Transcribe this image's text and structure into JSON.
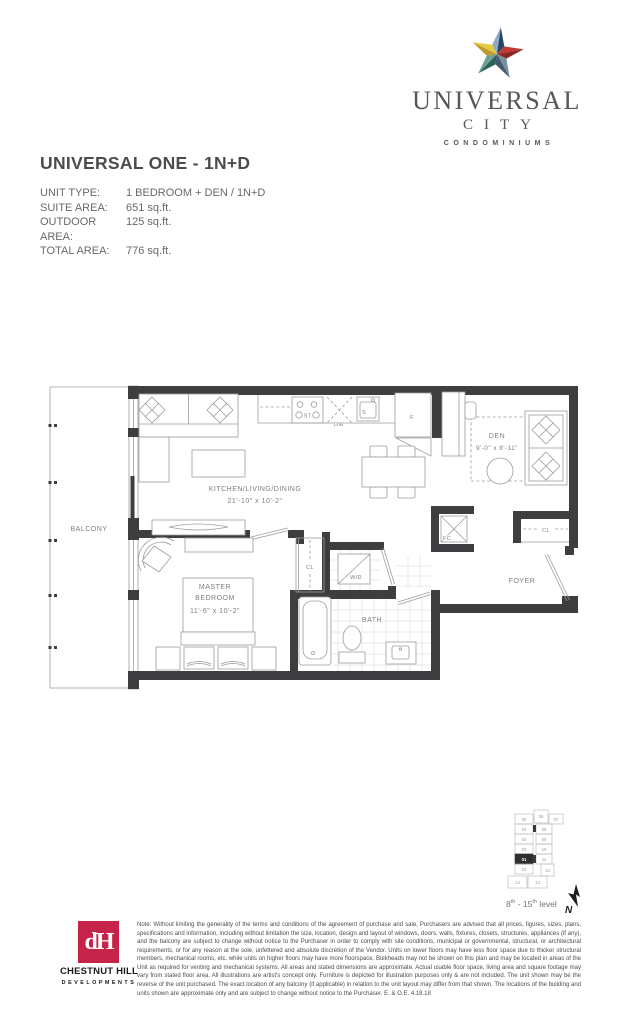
{
  "colors": {
    "wall": "#3e3e40",
    "accent": "#c5234a",
    "logogray": "#55575c",
    "star": [
      "#92a9c2",
      "#23456b",
      "#c23a31",
      "#8c2824",
      "#78909f",
      "#41586d",
      "#2f6257",
      "#6fa096",
      "#bf9a2f",
      "#e6ca3e"
    ]
  },
  "logo": {
    "line1": "UNIVERSAL",
    "line2": "CITY",
    "line3": "CONDOMINIUMS"
  },
  "title": "UNIVERSAL ONE - 1N+D",
  "info": {
    "rows": [
      {
        "label": "UNIT TYPE:",
        "value": "1 BEDROOM + DEN / 1N+D"
      },
      {
        "label": "SUITE AREA:",
        "value": "651 sq.ft."
      },
      {
        "label": "OUTDOOR AREA:",
        "value": "125 sq.ft."
      },
      {
        "label": "TOTAL AREA:",
        "value": "776 sq.ft."
      }
    ]
  },
  "floorplan": {
    "labels": {
      "balcony": "BALCONY",
      "kitchen": "KITCHEN/LIVING/DINING",
      "kitchen_dim": "21'-10\" x 10'-2\"",
      "den": "DEN",
      "den_dim": "9'-0\" x 8'-11\"",
      "master1": "MASTER",
      "master2": "BEDROOM",
      "master_dim": "11'-6\" x 10'-2\"",
      "bath": "BATH",
      "foyer": "FOYER",
      "wd": "W/D",
      "fc": "FC",
      "cl_hall": "CL",
      "cl_foyer": "CL",
      "fridge": "F",
      "sink": "S",
      "dw": "DW",
      "stove": "ST"
    }
  },
  "keyplan": {
    "units": [
      "05",
      "06",
      "07",
      "04",
      "08",
      "02",
      "09",
      "03",
      "10",
      "01",
      "11",
      "15",
      "12",
      "14",
      "13"
    ],
    "highlighted": "01",
    "level": {
      "p1": "8",
      "s1": "th",
      "p2": " - 15",
      "s2": "th",
      "p3": " level"
    },
    "north": "N"
  },
  "developer": {
    "monogram": "dH",
    "name": "CHESTNUT HILL",
    "sub": "DEVELOPMENTS"
  },
  "disclaimer": "Note: Without limiting the generality of the terms and conditions of the agreement of purchase and sale, Purchasers are advised that all prices, figures, sizes, plans, specifications and information, including without limitation the size, location, design and layout of windows, doors, walls, fixtures, closets, structures, appliances (if any), and the balcony are subject to change without notice to the Purchaser in order to comply with site conditions, municipal or governmental, structural, or architectural requirements, or for any reason at the sole, unfettered and absolute discretion of the Vendor. Units on lower floors may have less floor space due to thicker structural members, mechanical rooms, etc. while units on higher floors may have more floorspace. Bulkheads may not be shown on this plan and may be located in areas of the Unit as required for venting and mechanical systems. All areas and stated dimensions are approximate. Actual usable floor space, living area and square footage may vary from stated floor area. All illustrations are artist's concept only. Furniture is depicted for illustration purposes only & are not included. The unit shown may be the reverse of the unit purchased. The exact location of any balcony (if applicable) in relation to the unit layout may differ from that shown. The locations of the building and units shown are approximate only and are subject to change without notice to the Purchaser. E. & O.E. 4.18.18"
}
